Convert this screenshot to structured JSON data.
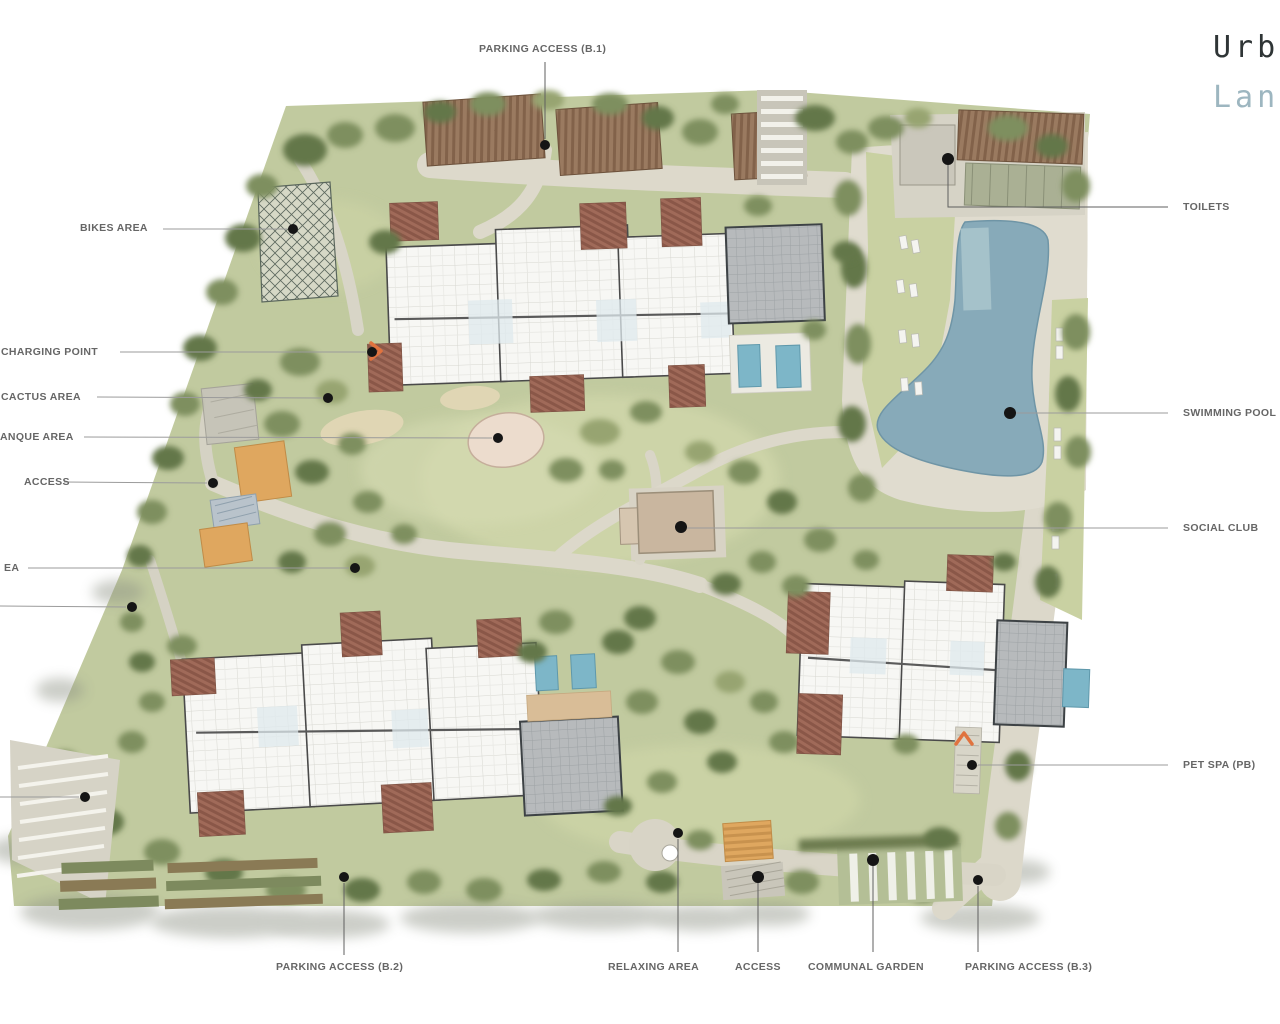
{
  "title": {
    "line1": "Urb",
    "line2": "Lan"
  },
  "labels": {
    "parking_b1": "PARKING ACCESS (B.1)",
    "bikes_area": "BIKES AREA",
    "charging_point": "CHARGING POINT",
    "cactus_area": "CACTUS AREA",
    "petanque_area": "ANQUE AREA",
    "access_left": "ACCESS",
    "area_left": "EA",
    "toilets": "TOILETS",
    "swimming_pool": "SWIMMING POOL",
    "social_club": "SOCIAL CLUB",
    "pet_spa": "PET SPA (PB)",
    "parking_b2": "PARKING ACCESS (B.2)",
    "relaxing_area": "RELAXING AREA",
    "access_bottom": "ACCESS",
    "communal_garden": "COMMUNAL GARDEN",
    "parking_b3": "PARKING ACCESS (B.3)"
  },
  "colors": {
    "title_dark": "#2f3536",
    "title_teal": "#9db6c0",
    "label_gray": "#666666",
    "site_green": "#c1ca9f",
    "pool_blue": "#87aab9",
    "terracotta": "#9c6656",
    "accent_orange": "#dfa75f",
    "roof_gray": "#b7babc"
  }
}
